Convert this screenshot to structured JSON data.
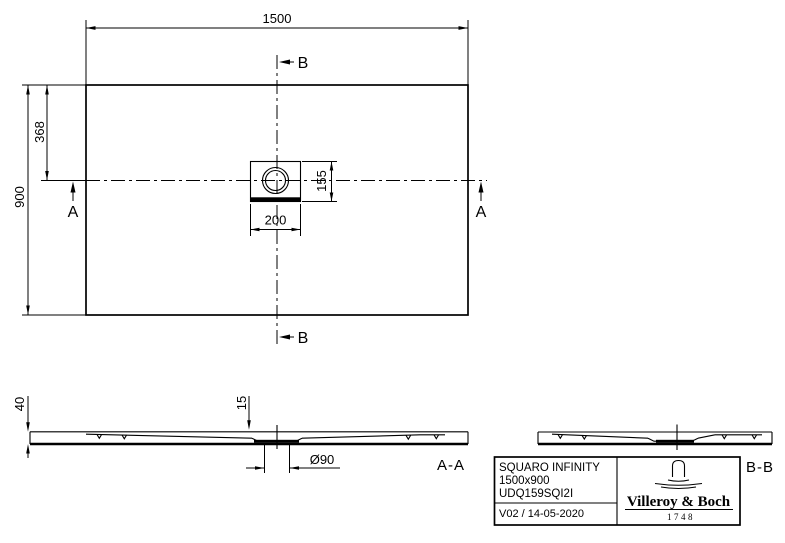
{
  "drawing": {
    "type": "technical-drawing",
    "colors": {
      "line": "#000000",
      "background": "#ffffff"
    },
    "plan": {
      "dim_width": "1500",
      "dim_depth": "900",
      "dim_drain_from_top": "368",
      "dim_drain_box_width": "200",
      "dim_drain_box_depth": "155",
      "marker_a": "A",
      "marker_b": "B"
    },
    "section_aa": {
      "label": "A-A",
      "dim_height": "40",
      "dim_recess": "15",
      "dim_drain": "Ø90"
    },
    "section_bb": {
      "label": "B-B"
    },
    "title_block": {
      "product": "SQUARO INFINITY",
      "size": "1500x900",
      "article": "UDQ159SQI2I",
      "revision": "V02 / 14-05-2020",
      "brand": "Villeroy & Boch",
      "year": "1748"
    }
  }
}
